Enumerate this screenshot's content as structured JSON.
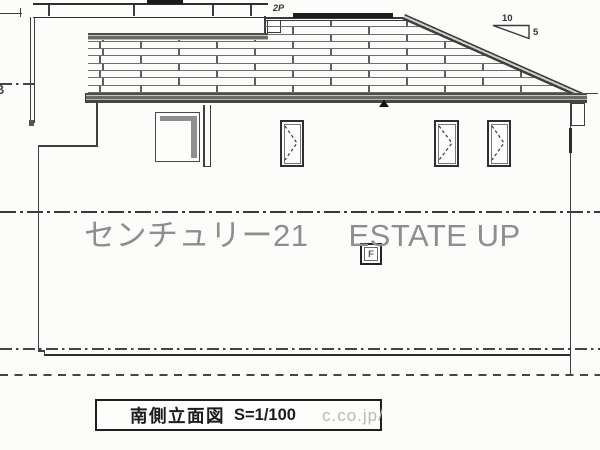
{
  "labels": {
    "floor": "2P",
    "slope_run": "10",
    "slope_rise": "5",
    "vent": "F",
    "margin_glyph": "B"
  },
  "title_block": {
    "title": "南側立面図",
    "scale": "S=1/100"
  },
  "watermark": {
    "brand_jp": "センチュリー21",
    "brand_en": "ESTATE UP",
    "url_fragment": "c.co.jp/",
    "color": "#8e8e8e"
  },
  "colors": {
    "line": "#3f3f3f",
    "paper": "#fcfcfb",
    "solar_bar": "#1c1c1c"
  }
}
